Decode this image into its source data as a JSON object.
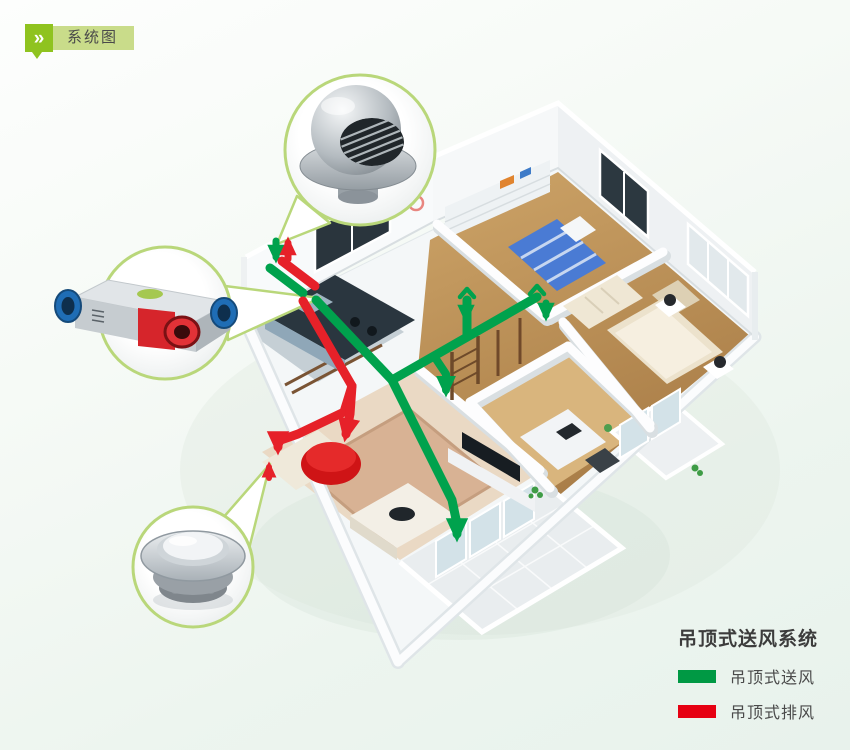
{
  "badge": {
    "chevron": "»",
    "label": "系统图"
  },
  "legend": {
    "title": "吊顶式送风系统",
    "items": [
      {
        "label": "吊顶式送风",
        "color": "#009944"
      },
      {
        "label": "吊顶式排风",
        "color": "#e60012"
      }
    ]
  },
  "diagram": {
    "type": "isometric-home-ventilation-cutaway",
    "supply_duct_color": "#00a24d",
    "exhaust_duct_color": "#e62129",
    "callout_ring_color": "#b9d77a",
    "callouts": [
      "outdoor-vent-hood",
      "heat-recovery-ventilator",
      "ceiling-diffuser"
    ]
  },
  "colors": {
    "badge_green": "#8fc31f",
    "badge_light_green": "#c9dc8a",
    "background": "#edf5ef"
  }
}
